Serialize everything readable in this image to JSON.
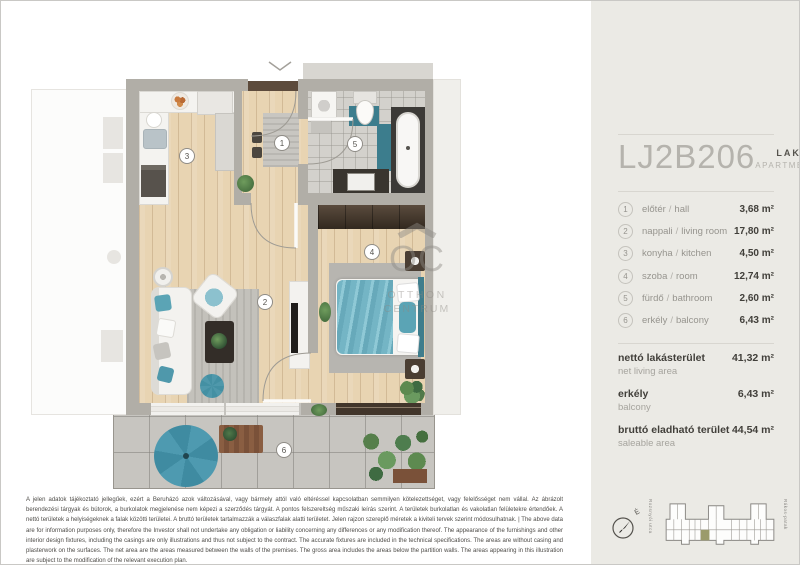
{
  "sidebar": {
    "unit_code": "LJ2B206",
    "type_hu": "LAKÁS",
    "type_en": "APARTMENT",
    "sep": "/",
    "rooms": [
      {
        "num": "1",
        "name_hu": "előtér",
        "name_en": "hall",
        "area": "3,68 m²"
      },
      {
        "num": "2",
        "name_hu": "nappali",
        "name_en": "living room",
        "area": "17,80 m²"
      },
      {
        "num": "3",
        "name_hu": "konyha",
        "name_en": "kitchen",
        "area": "4,50 m²"
      },
      {
        "num": "4",
        "name_hu": "szoba",
        "name_en": "room",
        "area": "12,74 m²"
      },
      {
        "num": "5",
        "name_hu": "fürdő",
        "name_en": "bathroom",
        "area": "2,60 m²"
      },
      {
        "num": "6",
        "name_hu": "erkély",
        "name_en": "balcony",
        "area": "6,43 m²"
      }
    ],
    "totals": [
      {
        "label_hu": "nettó lakásterület",
        "label_en": "net living area",
        "value": "41,32 m²"
      },
      {
        "label_hu": "erkély",
        "label_en": "balcony",
        "value": "6,43 m²"
      },
      {
        "label_hu": "bruttó eladható terület",
        "label_en": "saleable area",
        "value": "44,54 m²"
      }
    ]
  },
  "plan": {
    "room_numbers": [
      "1",
      "2",
      "3",
      "4",
      "5",
      "6"
    ],
    "watermark_abbr": "OC",
    "watermark_line1": "OTTHON",
    "watermark_line2": "CENTRUM"
  },
  "siteplan": {
    "compass_label": "É",
    "street_left": "Rozsnyói utca",
    "street_right": "Rákos-patak"
  },
  "footer": {
    "disclaimer_hu": "A jelen adatok tájékoztató jellegűek, ezért a Beruházó azok változásával, vagy bármely attól való eltéréssel kapcsolatban semmilyen kötelezettséget, vagy felelősséget nem vállal. Az ábrázolt berendezési tárgyak és bútorok, a burkolatok megjelenése nem képezi a szerződés tárgyát. A pontos felszereltség műszaki leírás szerint. A területek burkolatlan és vakolatlan felületekre értendőek. A nettó területek a helyiségeknek a falak közötti területei. A bruttó területek tartalmazzák a válaszfalak alatti területet. Jelen rajzon szereplő méretek a kiviteli tervek szerint módosulhatnak.",
    "sep": "|",
    "disclaimer_en": "The above data are for information purposes only, therefore the Investor shall not undertake any obligation or liability concerning any differences or any modification thereof. The appearance of the furnishings and other interior design fixtures, including the casings are only illustrations and thus not subject to the contract. The accurate fixtures are included in the technical specifications. The areas are without casing and plasterwork on the surfaces. The net area are the areas measured between the walls of the premises. The gross area includes the areas below the partition walls. The areas appearing in this illustration are subject to the modification of the relevant execution plan."
  },
  "colors": {
    "accent_teal": "#4f98ab",
    "wood_floor": "#e8d4b2",
    "sidebar_bg": "#ebeae5",
    "unit_highlight": "#9b9b6b",
    "wall_gray": "#b1aea7"
  }
}
